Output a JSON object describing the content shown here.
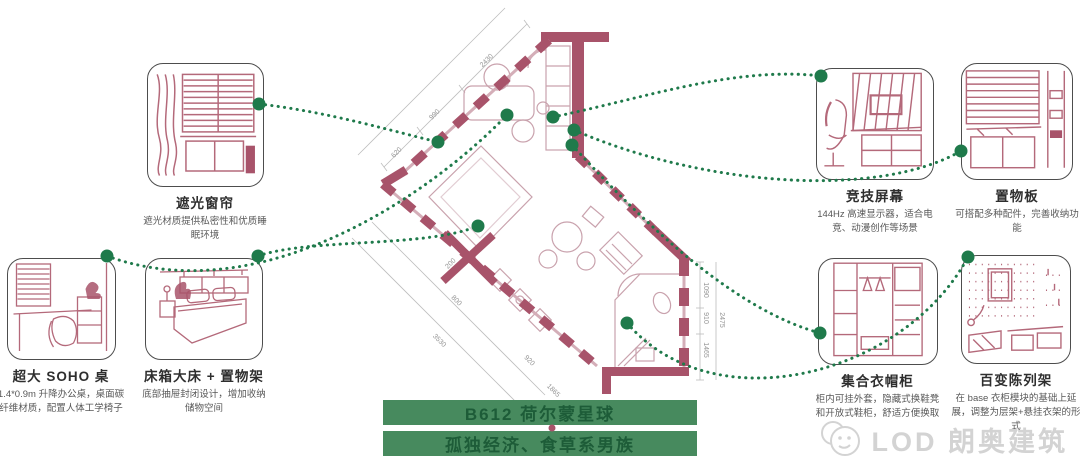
{
  "banner": {
    "line1": "B612 荷尔蒙星球",
    "line2": "孤独经济、食草系男族",
    "bg_color": "#478a5e",
    "text_color": "#1d5c38"
  },
  "watermark": {
    "text": "LOD 朗奥建筑"
  },
  "colors": {
    "wall": "#a8536a",
    "wall_light": "#d4aeb8",
    "sketch": "#b4697a",
    "leader_green": "#1f7a4b",
    "dimension_gray": "#949494"
  },
  "callouts": [
    {
      "id": "blackout-curtain",
      "title": "遮光窗帘",
      "desc": "遮光材质提供私密性和优质睡眠环境"
    },
    {
      "id": "soho-desk",
      "title": "超大 SOHO 桌",
      "desc": "1.4*0.9m 升降办公桌，桌面碳纤维材质，配置人体工学椅子"
    },
    {
      "id": "bed-storage",
      "title": "床箱大床 + 置物架",
      "desc": "底部抽屉封闭设计，增加收纳储物空间"
    },
    {
      "id": "gaming-screen",
      "title": "竞技屏幕",
      "desc": "144Hz 高速显示器，适合电竞、动漫创作等场景"
    },
    {
      "id": "shelf-board",
      "title": "置物板",
      "desc": "可搭配多种配件，完善收纳功能"
    },
    {
      "id": "wardrobe",
      "title": "集合衣帽柜",
      "desc": "柜内可挂外套，隐藏式换鞋凳和开放式鞋柜，舒适方便换取"
    },
    {
      "id": "display-rack",
      "title": "百变陈列架",
      "desc": "在 base 衣柜模块的基础上延展，调整为层架+悬挂衣架的形式"
    }
  ],
  "floor_plan": {
    "unit_name": "B612",
    "dimensions": [
      "2430",
      "990",
      "620",
      "200",
      "800",
      "3530",
      "920",
      "1865",
      "1090",
      "910",
      "1465",
      "2475"
    ]
  }
}
